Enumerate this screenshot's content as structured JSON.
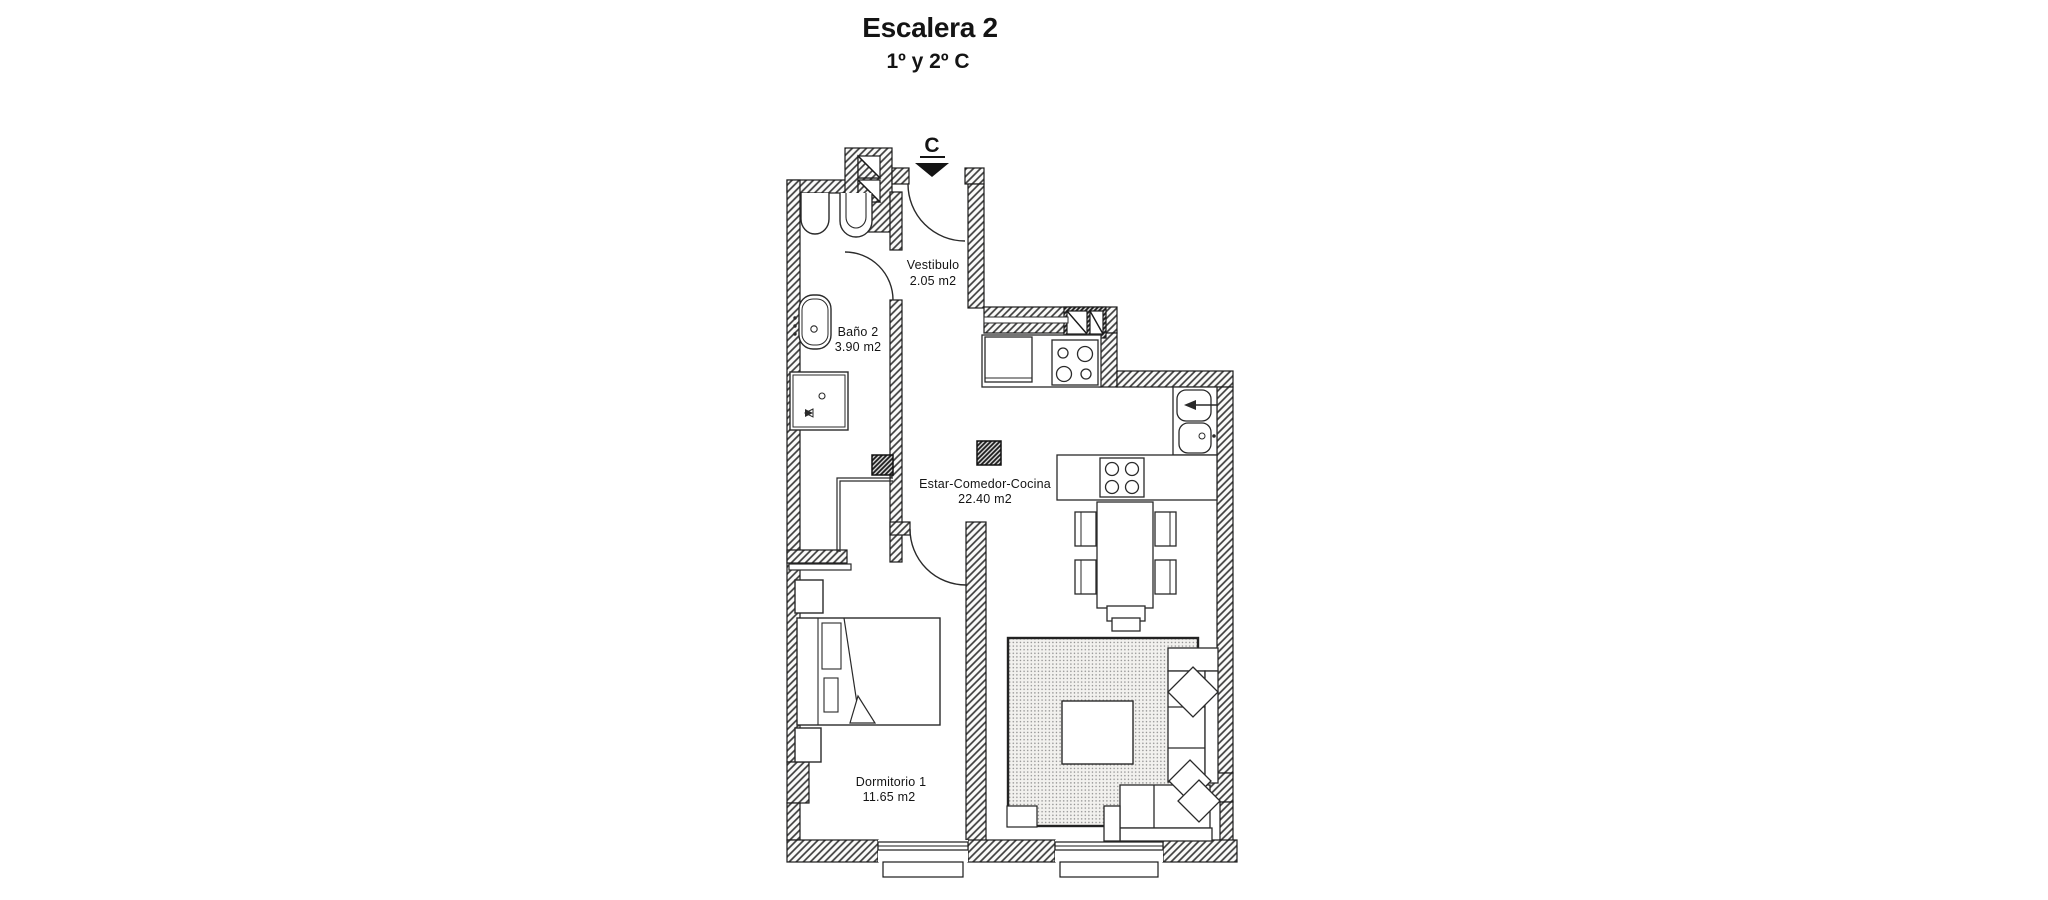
{
  "title": "Escalera 2",
  "subtitle": "1º y 2º C",
  "entrance_marker": "C",
  "rooms": {
    "vestibulo": {
      "name": "Vestibulo",
      "area": "2.05 m2"
    },
    "bano2": {
      "name": "Baño 2",
      "area": "3.90 m2"
    },
    "estar": {
      "name": "Estar-Comedor-Cocina",
      "area": "22.40 m2"
    },
    "dormitorio1": {
      "name": "Dormitorio 1",
      "area": "11.65 m2"
    }
  },
  "colors": {
    "ink": "#1a1a1a",
    "paper": "#ffffff",
    "rug_dot": "#8f8f8f"
  }
}
